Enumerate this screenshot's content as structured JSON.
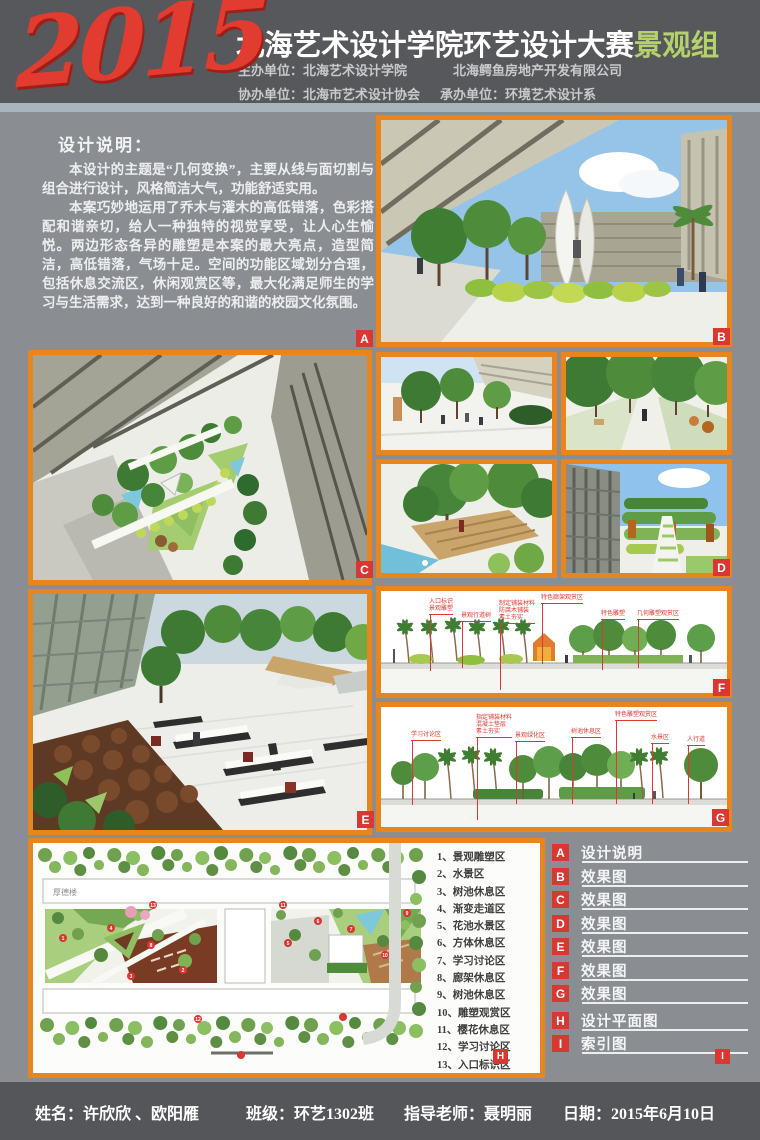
{
  "header": {
    "year": "2015",
    "title": "北海艺术设计学院环艺设计大赛",
    "group": "景观组",
    "host_label": "主办单位：",
    "host1": "北海艺术设计学院",
    "host2": "北海鳄鱼房地产开发有限公司",
    "co_label": "协办单位：",
    "co_org": "北海市艺术设计协会",
    "undertake_label": "承办单位：",
    "undertake_org": "环境艺术设计系"
  },
  "description": {
    "heading": "设计说明：",
    "para1": "本设计的主题是“几何变换”，主要从线与面切割与组合进行设计，风格简洁大气，功能舒适实用。",
    "para2": "本案巧妙地运用了乔木与灌木的高低错落，色彩搭配和谐亲切，给人一种独特的视觉享受，让人心生愉悦。两边形态各异的雕塑是本案的最大亮点，造型简洁，高低错落，气场十足。空间的功能区域划分合理，包括休息交流区，休闲观赏区等，最大化满足师生的学习与生活需求，达到一种良好的和谐的校园文化氛围。"
  },
  "legend": {
    "items": [
      {
        "key": "A",
        "label": "设计说明"
      },
      {
        "key": "B",
        "label": "效果图"
      },
      {
        "key": "C",
        "label": "效果图"
      },
      {
        "key": "D",
        "label": "效果图"
      },
      {
        "key": "E",
        "label": "效果图"
      },
      {
        "key": "F",
        "label": "效果图"
      },
      {
        "key": "G",
        "label": "效果图"
      },
      {
        "key": "H",
        "label": "设计平面图"
      },
      {
        "key": "I",
        "label": "索引图"
      }
    ]
  },
  "site_plan": {
    "building_label": "厚德楼",
    "items": [
      "1、景观雕塑区",
      "2、水景区",
      "3、树池休息区",
      "4、渐变走道区",
      "5、花池水景区",
      "6、方体休息区",
      "7、学习讨论区",
      "8、廊架休息区",
      "9、树池休息区",
      "10、雕塑观赏区",
      "11、樱花休息区",
      "12、学习讨论区",
      "13、入口标识区"
    ]
  },
  "section_f": {
    "annotations": [
      "入口标识",
      "景观雕塑",
      "景观行道树",
      "制定铺装材料",
      "防腐木铺装",
      "素土夯实",
      "特色廊架观赏区",
      "特色雕塑",
      "几何雕塑观赏区"
    ]
  },
  "section_g": {
    "annotations": [
      "学习讨论区",
      "指定铺装材料",
      "混凝土垫层",
      "素土夯实",
      "景观绿化区",
      "树池休息区",
      "特色雕塑观赏区",
      "水景区",
      "人行道"
    ]
  },
  "footer": {
    "name_label": "姓名：",
    "name_value": "许欣欣 、欧阳雁",
    "class_label": "班级：",
    "class_value": "环艺1302班",
    "teacher_label": "指导老师：",
    "teacher_value": "聂明丽",
    "date_label": "日期：",
    "date_value": "2015年6月10日"
  },
  "colors": {
    "accent_orange": "#E8851E",
    "marker_red": "#D93732",
    "group_green": "#B5D16B",
    "year_red": "#E23B30",
    "header_gray": "#57585B",
    "body_gray": "#8A8E93"
  }
}
